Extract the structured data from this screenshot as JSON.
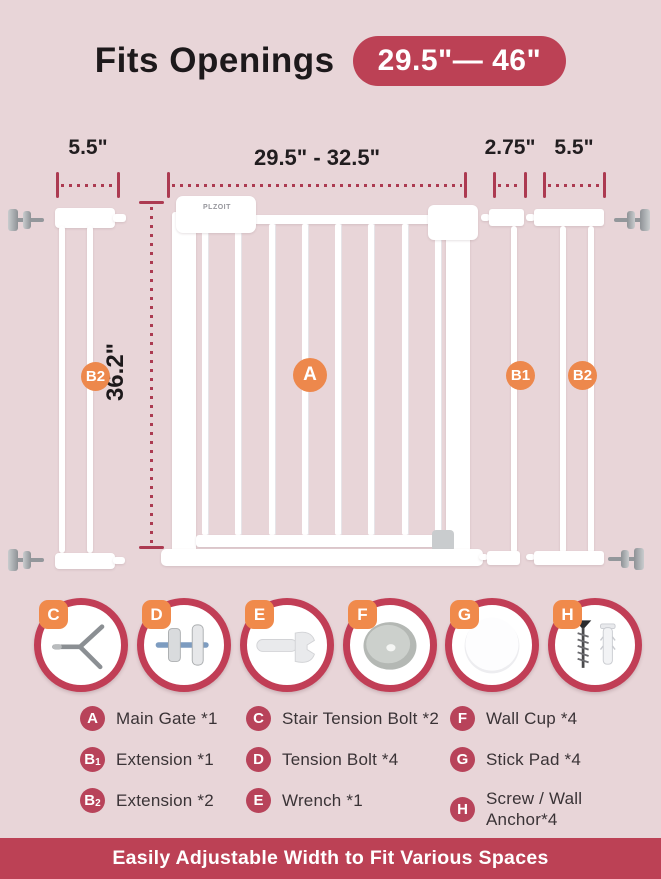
{
  "header": {
    "title": "Fits Openings",
    "range_badge": "29.5\"— 46\""
  },
  "dimensions": {
    "left_extension_width": "5.5\"",
    "gate_width_range": "29.5\" - 32.5\"",
    "b1_extension_width": "2.75\"",
    "right_extension_width": "5.5\"",
    "gate_height": "36.2\""
  },
  "gate": {
    "brand": "PLZOIT"
  },
  "markers": {
    "main_gate": "A",
    "left_extension": "B2",
    "extension_b1": "B1",
    "extension_b2": "B2"
  },
  "parts": [
    {
      "letter": "C",
      "icon": "stair-tension-bolt-icon"
    },
    {
      "letter": "D",
      "icon": "tension-bolt-icon"
    },
    {
      "letter": "E",
      "icon": "wrench-icon"
    },
    {
      "letter": "F",
      "icon": "wall-cup-icon"
    },
    {
      "letter": "G",
      "icon": "stick-pad-icon"
    },
    {
      "letter": "H",
      "icon": "screw-wall-anchor-icon"
    }
  ],
  "legend": {
    "col1": [
      {
        "letter": "A",
        "sub": "",
        "label": "Main Gate *1"
      },
      {
        "letter": "B",
        "sub": "1",
        "label": "Extension *1"
      },
      {
        "letter": "B",
        "sub": "2",
        "label": "Extension *2"
      }
    ],
    "col2": [
      {
        "letter": "C",
        "sub": "",
        "label": "Stair Tension Bolt *2"
      },
      {
        "letter": "D",
        "sub": "",
        "label": "Tension Bolt *4"
      },
      {
        "letter": "E",
        "sub": "",
        "label": "Wrench *1"
      }
    ],
    "col3": [
      {
        "letter": "F",
        "sub": "",
        "label": "Wall Cup *4"
      },
      {
        "letter": "G",
        "sub": "",
        "label": "Stick Pad *4"
      },
      {
        "letter": "H",
        "sub": "",
        "label": "Screw / Wall Anchor*4"
      }
    ]
  },
  "footer": {
    "text": "Easily Adjustable Width to Fit Various Spaces"
  },
  "colors": {
    "background": "#E8D5D8",
    "accent_crimson": "#BC4155",
    "marker_orange": "#ED884C",
    "dimension_line": "#AC3A51"
  }
}
